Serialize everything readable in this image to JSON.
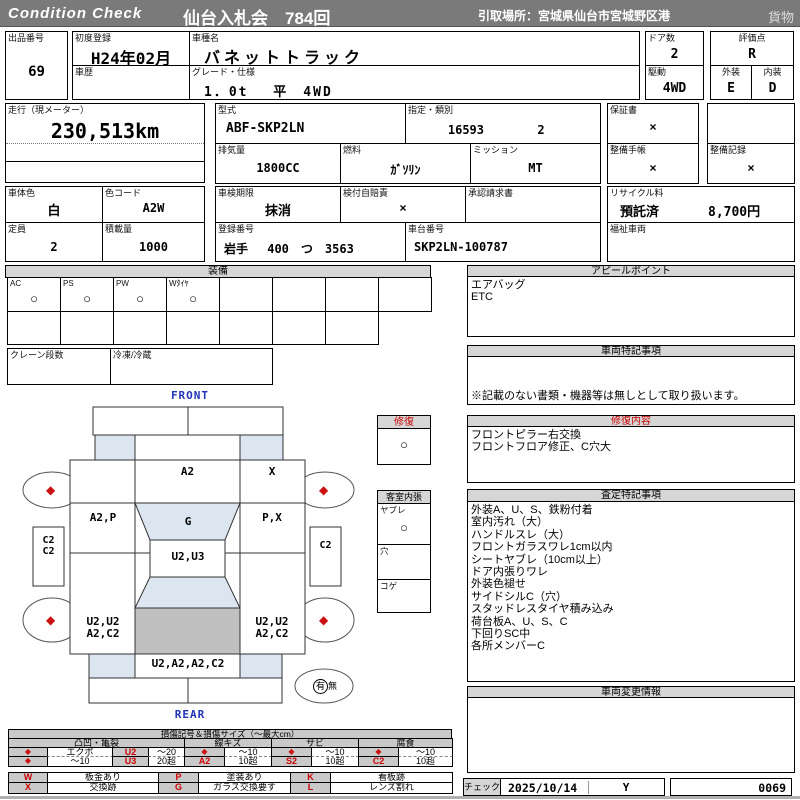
{
  "header": {
    "brand": "Condition  Check",
    "auction": "仙台入札会　784回",
    "pickup": "引取場所：宮城県仙台市宮城野区港",
    "cargo": "貨物"
  },
  "info": {
    "lot": {
      "label": "出品番号",
      "value": "69"
    },
    "first_reg": {
      "label": "初度登録",
      "value": "H24年02月"
    },
    "history": {
      "label": "車歴",
      "value": ""
    },
    "model": {
      "label": "車種名",
      "value": "バネットトラック"
    },
    "grade": {
      "label": "グレード・仕様",
      "value": "1．0t　 平　4WD"
    },
    "doors": {
      "label": "ドア数",
      "value": "2"
    },
    "score": {
      "label": "評価点",
      "value": "R"
    },
    "drive": {
      "label": "駆動",
      "value": "4WD"
    },
    "exterior": {
      "label": "外装",
      "value": "E"
    },
    "interior": {
      "label": "内装",
      "value": "D"
    },
    "mileage": {
      "label": "走行（現メーター）",
      "value": "230,513km"
    },
    "model_code": {
      "label": "型式",
      "value": "ABF-SKP2LN"
    },
    "class": {
      "label": "指定・類別",
      "value1": "16593",
      "value2": "2"
    },
    "displacement": {
      "label": "排気量",
      "value": "1800CC"
    },
    "fuel": {
      "label": "燃料",
      "value": "ｶﾞｿﾘﾝ"
    },
    "mission": {
      "label": "ミッション",
      "value": "MT"
    },
    "warranty": {
      "label": "保証書",
      "value": "×"
    },
    "maint_book": {
      "label": "整備手帳",
      "value": "×"
    },
    "maint_record": {
      "label": "整備記録",
      "value": "×"
    },
    "body_color": {
      "label": "車体色",
      "value": "白"
    },
    "color_code": {
      "label": "色コード",
      "value": "A2W"
    },
    "inspection": {
      "label": "車検期限",
      "value": "抹消"
    },
    "insurance": {
      "label": "検付自賠責",
      "value": "×"
    },
    "approval": {
      "label": "承認請求書",
      "value": ""
    },
    "recycle": {
      "label": "リサイクル料",
      "status": "預託済",
      "fee": "8,700円"
    },
    "capacity": {
      "label": "定員",
      "value": "2"
    },
    "load": {
      "label": "積載量",
      "value": "1000"
    },
    "reg_no": {
      "label": "登録番号",
      "value": "岩手　 400　つ　3563"
    },
    "chassis": {
      "label": "車台番号",
      "value": "SKP2LN-100787"
    },
    "welfare": {
      "label": "福祉車両",
      "value": ""
    }
  },
  "equipment": {
    "title": "装備",
    "items": [
      {
        "label": "AC",
        "mark": "○"
      },
      {
        "label": "PS",
        "mark": "○"
      },
      {
        "label": "PW",
        "mark": "○"
      },
      {
        "label": "Wﾀｲﾔ",
        "mark": "○"
      },
      {
        "label": "",
        "mark": ""
      },
      {
        "label": "",
        "mark": ""
      },
      {
        "label": "",
        "mark": ""
      },
      {
        "label": "",
        "mark": ""
      }
    ],
    "crane": {
      "label": "クレーン段数",
      "value": ""
    },
    "fridge": {
      "label": "冷凍/冷蔵",
      "value": ""
    }
  },
  "diagram": {
    "front_label": "FRONT",
    "rear_label": "REAR",
    "wheel_mark": "◆",
    "repair": {
      "title": "修復",
      "mark": "○"
    },
    "cabin_lining": {
      "title": "客室内張",
      "rows": [
        {
          "label": "ヤブレ",
          "mark": "○"
        },
        {
          "label": "穴",
          "mark": ""
        },
        {
          "label": "コゲ",
          "mark": ""
        }
      ]
    },
    "panels": {
      "hood": "A2",
      "front_right": "X",
      "door_left": "A2,P",
      "roof_glass": "G",
      "door_right": "P,X",
      "cab_center": "U2,U3",
      "sill_left_1": "C2",
      "sill_left_2": "C2",
      "sill_right": "C2",
      "bed_left_1": "U2,U2",
      "bed_left_2": "A2,C2",
      "bed_right_1": "U2,U2",
      "bed_right_2": "A2,C2",
      "rear_panel": "U2,A2,A2,C2"
    },
    "spare": {
      "yes": "有",
      "no": "無"
    }
  },
  "right_panel": {
    "appeal": {
      "title": "アピールポイント",
      "lines": [
        "エアバッグ",
        "ETC"
      ]
    },
    "notes": {
      "title": "車両特記事項",
      "disclaimer": "※記載のない書類・機器等は無しとして取り扱います。"
    },
    "repair_detail": {
      "title": "修復内容",
      "lines": [
        "フロントピラー右交換",
        "フロントフロア修正、C穴大"
      ]
    },
    "assessment": {
      "title": "査定特記事項",
      "lines": [
        "外装A、U、S、鉄粉付着",
        "室内汚れ（大）",
        "ハンドルスレ（大）",
        "フロントガラスワレ1cm以内",
        "シートヤブレ（10cm以上）",
        "ドア内張りワレ",
        "外装色褪せ",
        "サイドシルC（穴）",
        "スタッドレスタイヤ積み込み",
        "荷台板A、U、S、C",
        "下回りSC中",
        "各所メンバーC"
      ]
    },
    "change_info": {
      "title": "車両変更情報"
    },
    "check": {
      "label": "チェック",
      "date": "2025/10/14",
      "mark": "Y",
      "number": "0069"
    }
  },
  "legend": {
    "title": "損傷記号＆損傷サイズ（～最大cm）",
    "diamond": "◆",
    "groups": {
      "dent": "凸凹・亀裂",
      "scratch": "線キズ",
      "rust": "サビ",
      "corrosion": "腐食"
    },
    "dent": {
      "r1_name": "エクボ",
      "r1_code": "U2",
      "r1_size": "～20",
      "r2_name": "～10",
      "r2_code": "U3",
      "r2_size": "20超"
    },
    "scratch": {
      "r1_size": "～10",
      "r2_code": "A2",
      "r2_size": "10超"
    },
    "rust": {
      "r1_size": "～10",
      "r2_code": "S2",
      "r2_size": "10超"
    },
    "corrosion": {
      "r1_size": "～10",
      "r2_code": "C2",
      "r2_size": "10超"
    },
    "codes": {
      "w": {
        "code": "W",
        "desc": "板金あり"
      },
      "p": {
        "code": "P",
        "desc": "塗装あり"
      },
      "k": {
        "code": "K",
        "desc": "看板跡"
      },
      "x": {
        "code": "X",
        "desc": "交換跡"
      },
      "g": {
        "code": "G",
        "desc": "ガラス交換要す"
      },
      "l": {
        "code": "L",
        "desc": "レンズ割れ"
      }
    }
  }
}
